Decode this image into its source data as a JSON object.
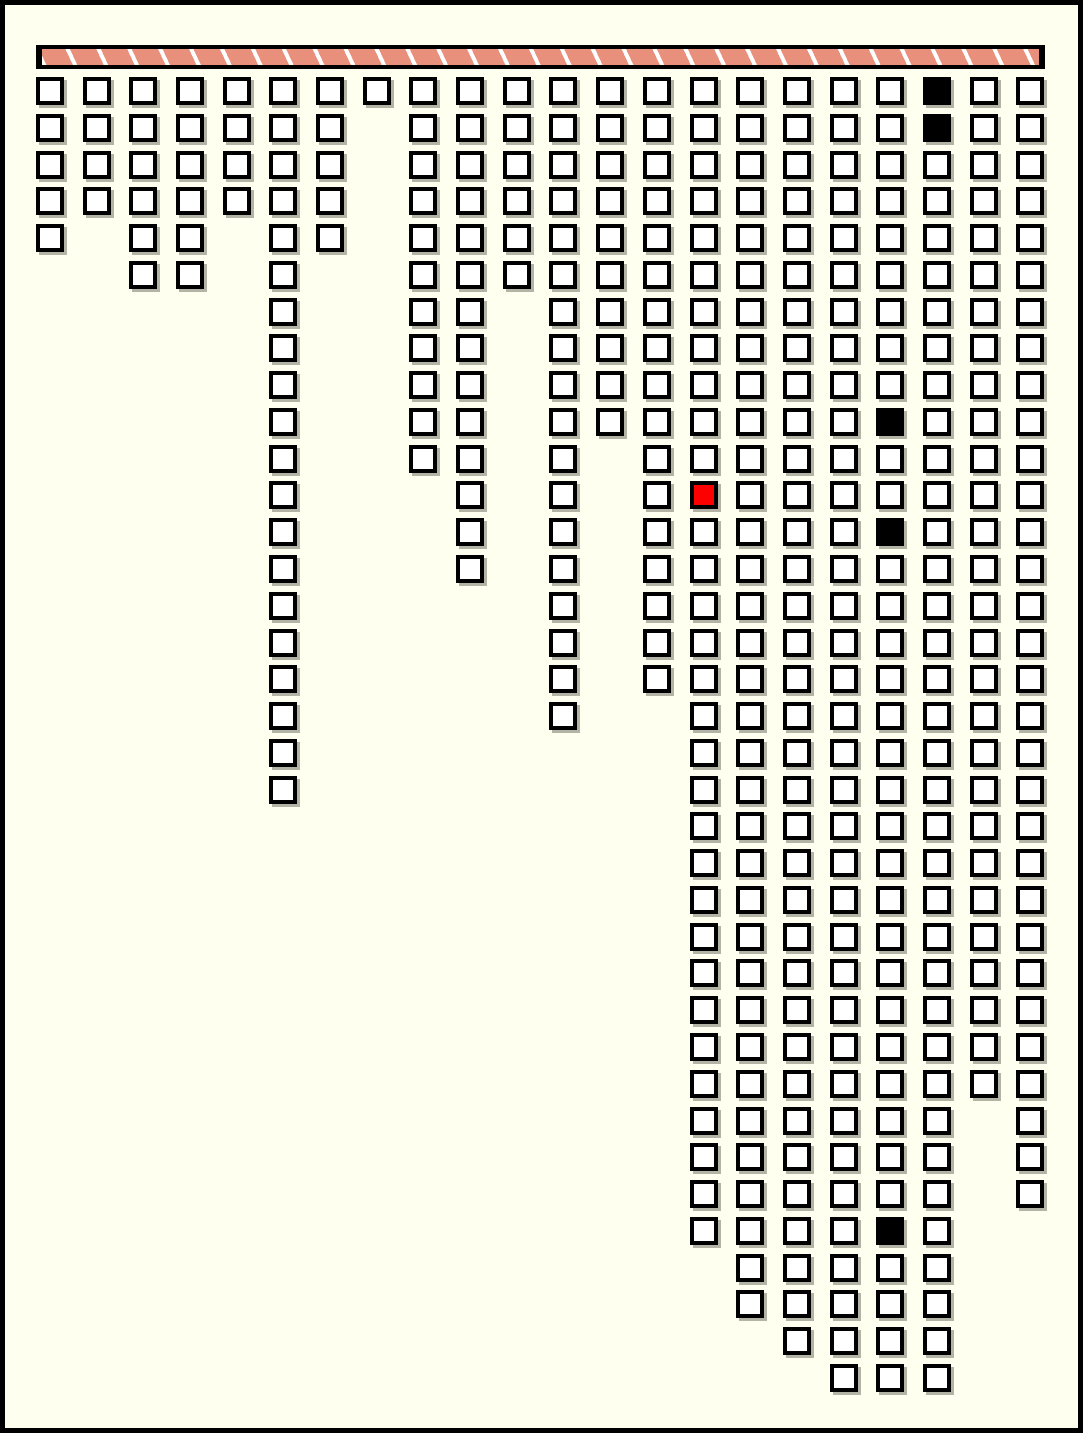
{
  "page": {
    "background": "#FFFFF0",
    "frame_color": "#000000"
  },
  "header_bar": {
    "frame_color": "#000000",
    "stripe_fill": "#E8907C",
    "stripe_gap_color": "#FFFFFF",
    "segment_count": 32,
    "stripe_direction": "slash-leaning-right"
  },
  "chart_data": {
    "type": "bar",
    "subtype": "unit-waffle-columns",
    "orientation": "columns hang downward from header bar, one square per unit",
    "categories": [
      1,
      2,
      3,
      4,
      5,
      6,
      7,
      8,
      9,
      10,
      11,
      12,
      13,
      14,
      15,
      16,
      17,
      18,
      19,
      20,
      21,
      22
    ],
    "values": [
      5,
      4,
      6,
      6,
      4,
      20,
      5,
      1,
      11,
      14,
      6,
      18,
      10,
      17,
      32,
      34,
      35,
      36,
      36,
      36,
      28,
      31
    ],
    "title": "",
    "xlabel": "",
    "ylabel": "",
    "ylim": [
      0,
      36
    ],
    "grid_lines": false,
    "legend": false,
    "total_units": 395,
    "cell_fill": "#FFFFFF",
    "cell_border": "#000000",
    "cell_shadow": "rgba(40,40,30,0.35)",
    "marked_cells": [
      {
        "col": 19,
        "row": 0,
        "fill": "#000000"
      },
      {
        "col": 19,
        "row": 1,
        "fill": "#000000"
      },
      {
        "col": 18,
        "row": 9,
        "fill": "#000000"
      },
      {
        "col": 18,
        "row": 12,
        "fill": "#000000"
      },
      {
        "col": 18,
        "row": 31,
        "fill": "#000000"
      },
      {
        "col": 14,
        "row": 11,
        "fill": "#FF0000"
      }
    ]
  }
}
